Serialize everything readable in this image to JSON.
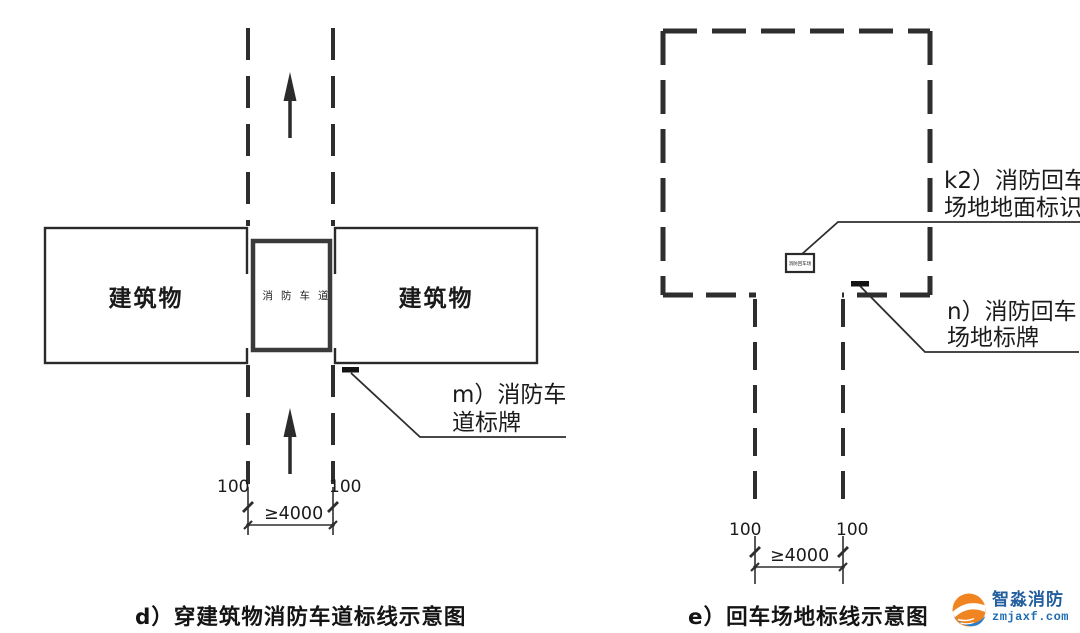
{
  "diagram_d": {
    "caption": "d）穿建筑物消防车道标线示意图",
    "building_left_label": "建筑物",
    "building_right_label": "建筑物",
    "lane_box_label": "消防车道",
    "sign_callout_line1": "m）消防车",
    "sign_callout_line2": "道标牌",
    "dim_line_width_left": "100",
    "dim_line_width_right": "100",
    "dim_road_width": "≥4000"
  },
  "diagram_e": {
    "caption": "e）回车场地标线示意图",
    "ground_marking_callout_line1": "k2）消防回车",
    "ground_marking_callout_line2": "场地地面标识",
    "ground_marking_box_text": "消防回车场",
    "sign_callout_line1": "n）消防回车",
    "sign_callout_line2": "场地标牌",
    "dim_line_width_left": "100",
    "dim_line_width_right": "100",
    "dim_road_width": "≥4000"
  },
  "logo": {
    "title": "智淼消防",
    "domain": "zmjaxf.com",
    "orange": "#ef8420",
    "blue": "#2a80c8",
    "text_color": "#235e9e"
  },
  "colors": {
    "line": "#2e2e2e",
    "thick_box": "#3a3a3a",
    "background": "#ffffff"
  }
}
